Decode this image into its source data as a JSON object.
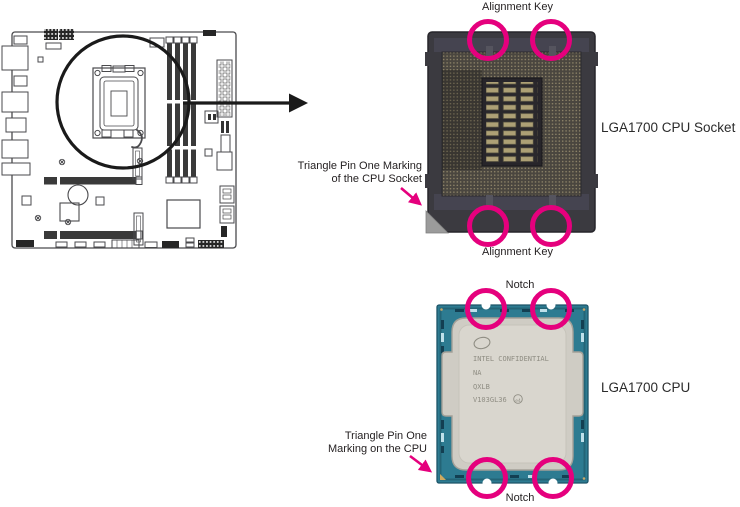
{
  "colors": {
    "highlight_magenta": "#e5007d",
    "socket_body_gray": "#3b3a40",
    "cpu_pcb_teal": "#2d7b91",
    "cpu_ihs_silver": "#d8d5cd",
    "pin1_triangle_gray": "#9b9b9b",
    "label_text": "#231f20"
  },
  "socket_section": {
    "alignment_key_top": "Alignment Key",
    "alignment_key_bottom": "Alignment Key",
    "title": "LGA1700 CPU Socket",
    "triangle_label_line1": "Triangle Pin One Marking",
    "triangle_label_line2": "of the CPU Socket"
  },
  "cpu_section": {
    "notch_top": "Notch",
    "notch_bottom": "Notch",
    "title": "LGA1700 CPU",
    "triangle_label_line1": "Triangle Pin One",
    "triangle_label_line2": "Marking on the CPU",
    "ihs_markings": {
      "line1": "INTEL CONFIDENTIAL",
      "line2": "NA",
      "line3": "QXLB",
      "line4": "V103GL36",
      "badge": "e4"
    }
  }
}
